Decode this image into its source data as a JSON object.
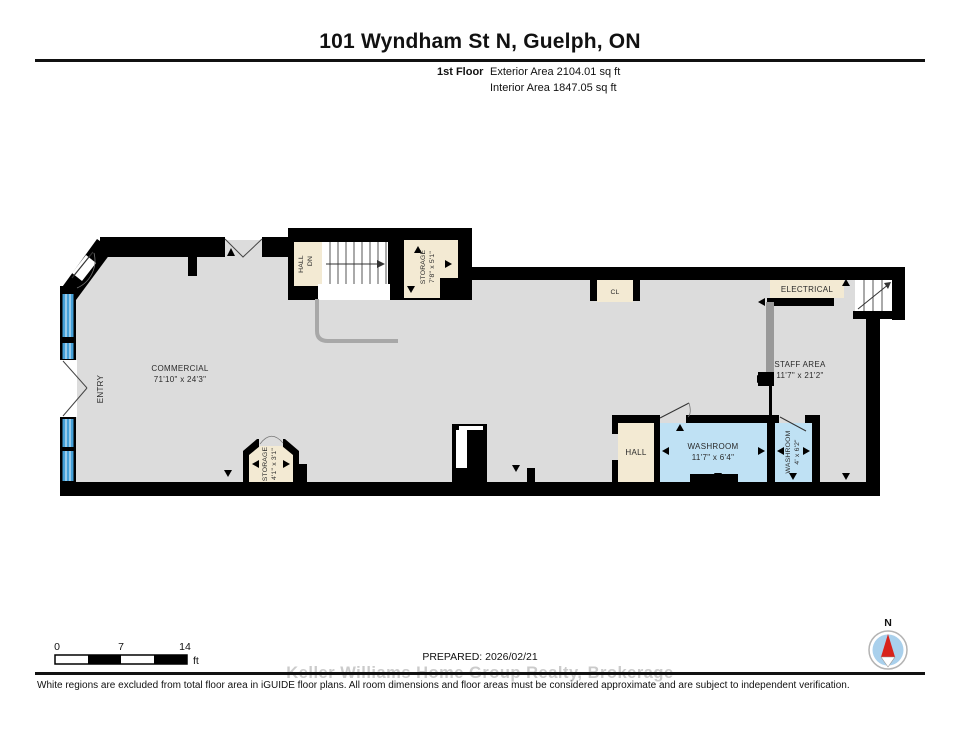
{
  "header": {
    "title": "101 Wyndham St N, Guelph, ON",
    "floor_label": "1st Floor",
    "exterior_area": "Exterior Area 2104.01 sq ft",
    "interior_area": "Interior Area 1847.05 sq ft"
  },
  "plan": {
    "rooms": {
      "commercial": {
        "name": "COMMERCIAL",
        "dims": "71'10\" x 24'3\""
      },
      "entry": {
        "name": "ENTRY"
      },
      "hall_dn": {
        "name": "HALL",
        "direction": "DN"
      },
      "storage_top": {
        "name": "STORAGE",
        "dims": "7'8\" x 5'1\""
      },
      "storage_bottom": {
        "name": "STORAGE",
        "dims": "4'1\" x 3'1\""
      },
      "closet": {
        "name": "CL"
      },
      "electrical": {
        "name": "ELECTRICAL"
      },
      "staff_area": {
        "name": "STAFF AREA",
        "dims": "11'7\" x 21'2\""
      },
      "hall": {
        "name": "HALL"
      },
      "washroom_main": {
        "name": "WASHROOM",
        "dims": "11'7\" x 6'4\""
      },
      "washroom_small": {
        "name": "WASHROOM",
        "dims": "4' x 6'2\""
      }
    },
    "colors": {
      "floor": "#dcdcdc",
      "wall": "#000000",
      "room_beige": "#f3ead3",
      "washroom_blue": "#bfe1f4",
      "window_blue": "#44a0d8",
      "railing_gray": "#a8a8a8"
    }
  },
  "scale_bar": {
    "tick_0": "0",
    "tick_7": "7",
    "tick_14": "14",
    "unit": "ft"
  },
  "compass": {
    "north_label": "N"
  },
  "footer": {
    "prepared": "PREPARED: 2026/02/21",
    "watermark": "Keller Williams Home Group Realty, Brokerage",
    "disclaimer": "White regions are excluded from total floor area in iGUIDE floor plans. All room dimensions and floor areas must be considered approximate and are subject to independent verification."
  }
}
